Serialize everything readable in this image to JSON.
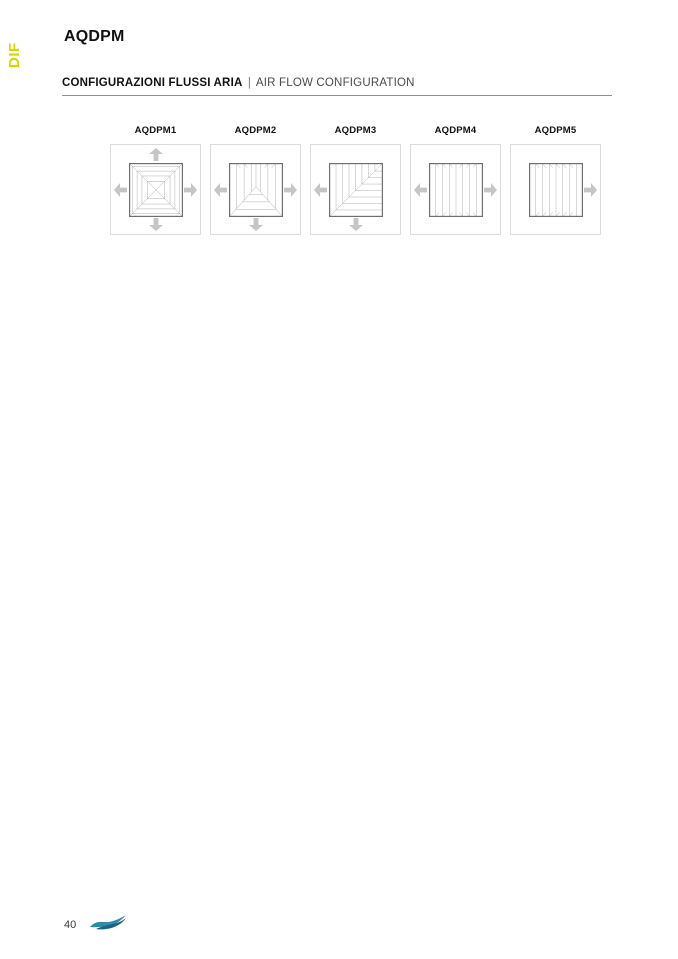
{
  "sidebar": {
    "label": "DIF"
  },
  "header": {
    "title": "AQDPM"
  },
  "section": {
    "title_it": "CONFIGURAZIONI FLUSSI ARIA",
    "separator": "|",
    "title_en": "AIR FLOW CONFIGURATION"
  },
  "diffusers": {
    "items": [
      {
        "label": "AQDPM1",
        "airflow": "4-way",
        "arrows": [
          "up",
          "down",
          "left",
          "right"
        ]
      },
      {
        "label": "AQDPM2",
        "airflow": "3-way",
        "arrows": [
          "left",
          "right",
          "down"
        ]
      },
      {
        "label": "AQDPM3",
        "airflow": "2-way-corner",
        "arrows": [
          "left",
          "down"
        ]
      },
      {
        "label": "AQDPM4",
        "airflow": "2-way-opposite",
        "arrows": [
          "left",
          "right"
        ]
      },
      {
        "label": "AQDPM5",
        "airflow": "1-way",
        "arrows": [
          "right"
        ]
      }
    ]
  },
  "footer": {
    "page_number": "40",
    "logo": "wave-logo"
  },
  "colors": {
    "accent_lime": "#d3d800",
    "arrow_gray": "#c5c5c5",
    "frame_border": "#dcdcdc",
    "line_art_dark": "#6e6e6e",
    "line_art_light": "#a3a3a3",
    "logo_teal": "#2e8ca3",
    "logo_blue": "#1d5f86"
  }
}
